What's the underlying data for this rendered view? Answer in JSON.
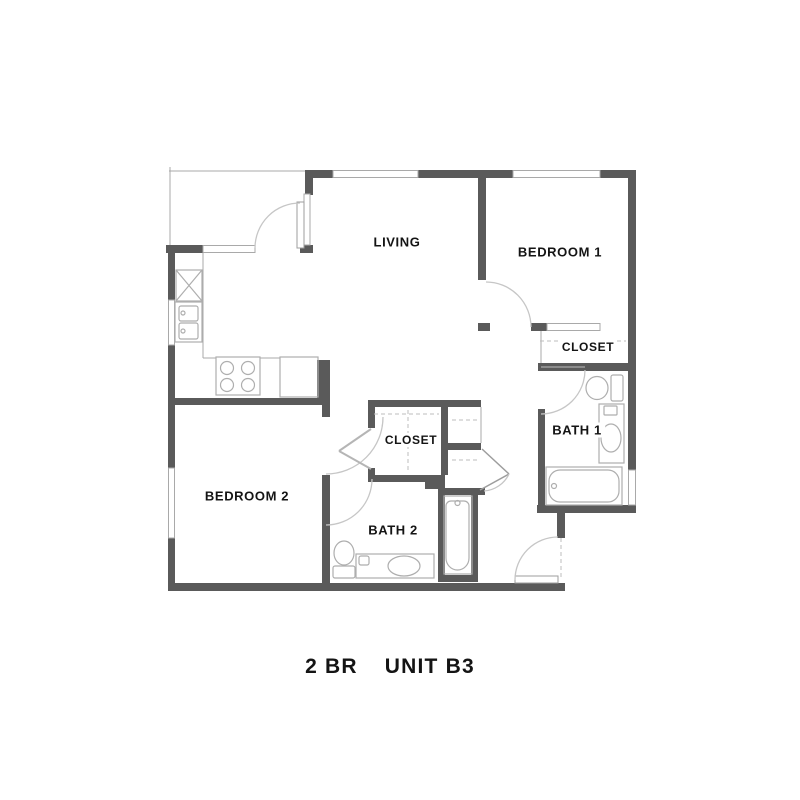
{
  "title": {
    "left": "2 BR",
    "right": "UNIT B3"
  },
  "rooms": {
    "living": "LIVING",
    "bedroom1": "BEDROOM 1",
    "bedroom2": "BEDROOM 2",
    "bath1": "BATH 1",
    "bath2": "BATH 2",
    "closet_bedroom1": "CLOSET",
    "closet_hall": "CLOSET"
  },
  "legend": {
    "fixtures": [
      "refrigerator",
      "kitchen-double-sink",
      "stove-4-burners",
      "dishwasher-counter",
      "toilet-bath1",
      "vanity-sink-bath1",
      "bathtub-bath1",
      "toilet-bath2",
      "vanity-sink-bath2",
      "bathtub-bath2",
      "door-swing-arcs",
      "windows",
      "closet-shelving"
    ]
  },
  "colors": {
    "wall": "#5a5a5a",
    "thin": "#a9a9a9",
    "arc": "#c6c6c6",
    "fixture": "#aeaeae",
    "text": "#141414",
    "bg": "#ffffff"
  }
}
